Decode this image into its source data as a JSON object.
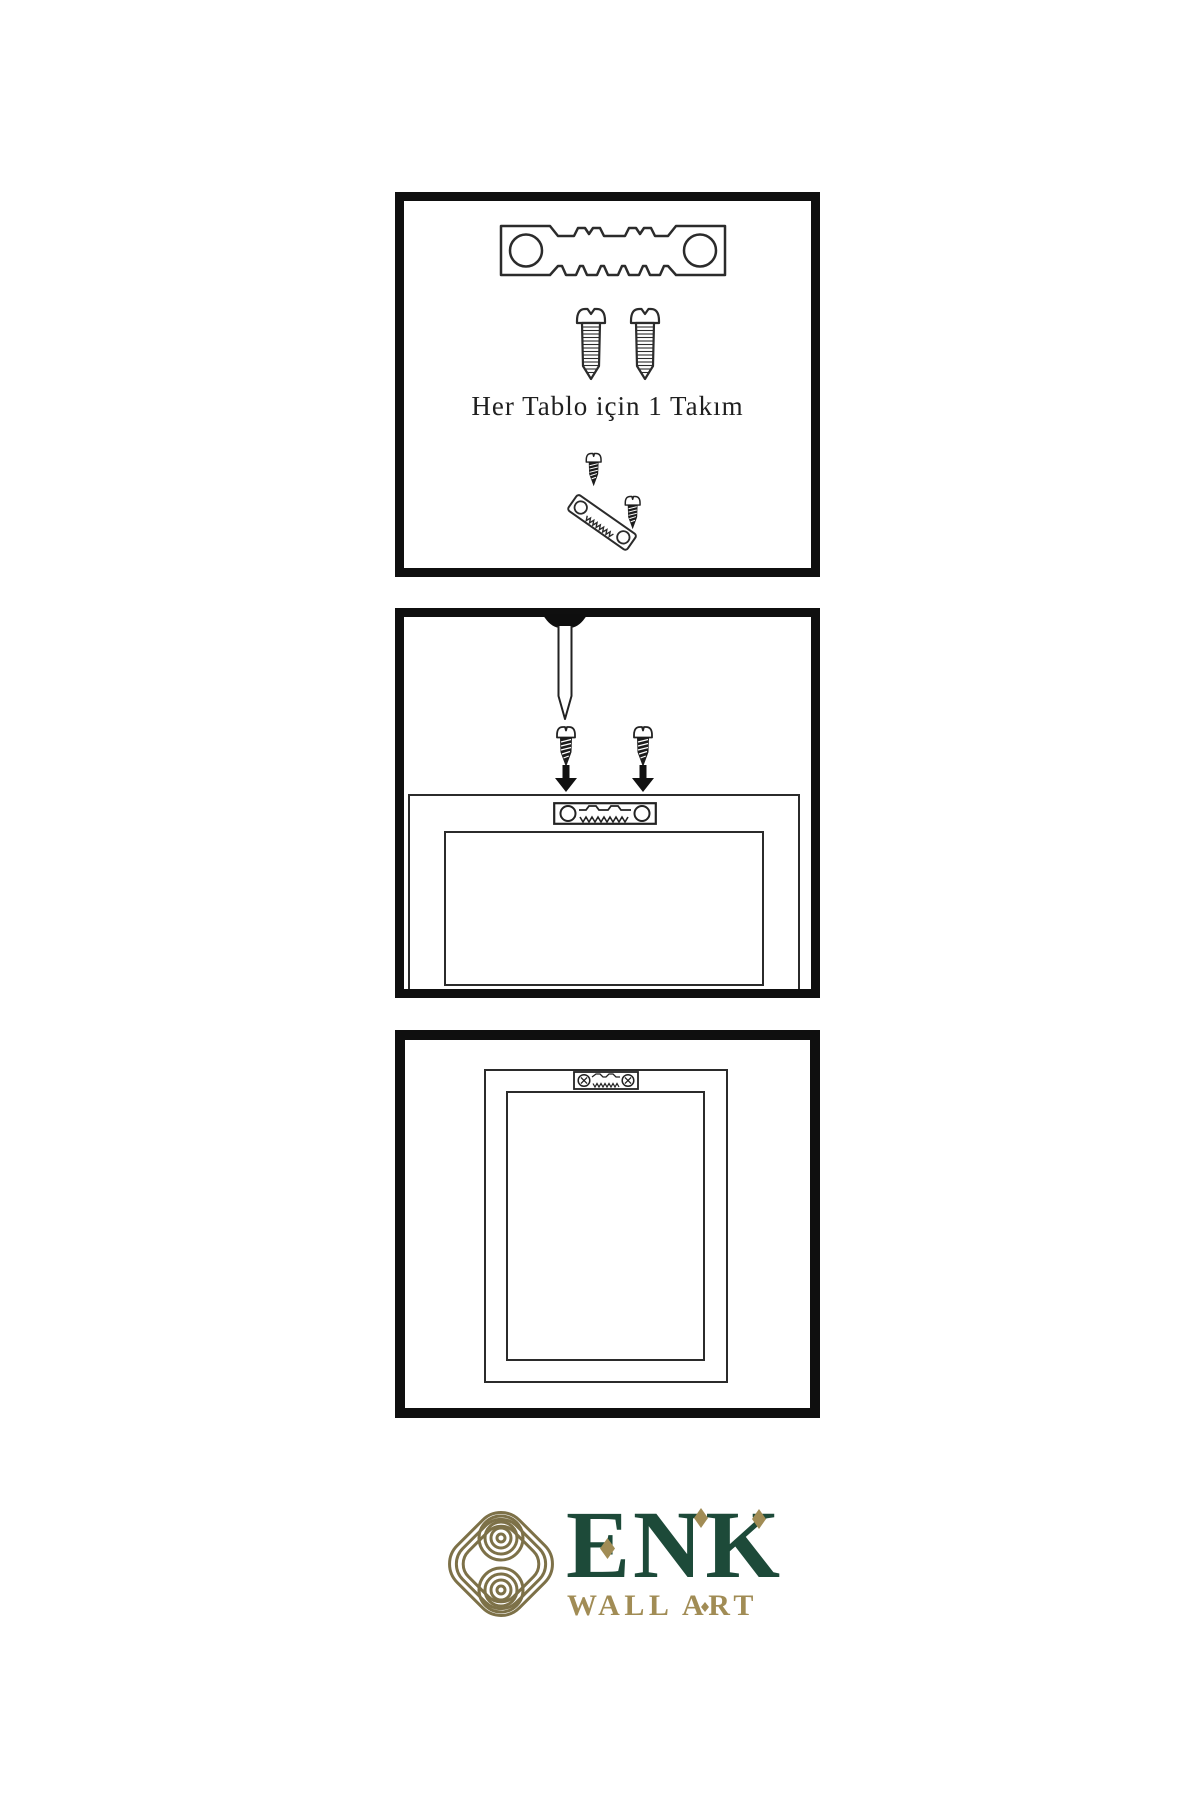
{
  "panel_kit": {
    "caption": "Her Tablo için 1 Takım"
  },
  "brand": {
    "name": "ENK",
    "subtitle": "WALL ART"
  },
  "colors": {
    "panel_border": "#0f0f0f",
    "line_ink": "#2b2b2b",
    "brand_green": "#1d4a39",
    "brand_gold": "#a18c55",
    "knot_gold": "#7d7148"
  }
}
